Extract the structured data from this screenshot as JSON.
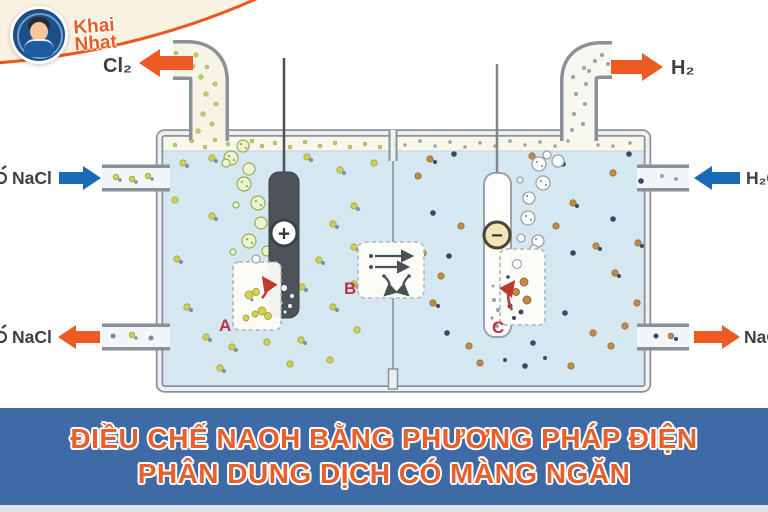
{
  "brand": {
    "line1": "Khai",
    "line2": "Nhat"
  },
  "diagram": {
    "gas_left_label": "Cl₂",
    "gas_right_label": "H₂",
    "inlet_left_label": "NaCl",
    "outlet_left_label": "NaCl",
    "inlet_right_label": "H₂O",
    "outlet_right_label": "NaOH",
    "anode_sign": "+",
    "cathode_sign": "−",
    "inset_a": "A",
    "inset_b": "B",
    "inset_c": "C"
  },
  "banner": {
    "line1": "ĐIỀU CHẾ NAOH BẰNG PHƯƠNG PHÁP ĐIỆN",
    "line2": "PHÂN DUNG DỊCH CÓ MÀNG NGĂN"
  },
  "colors": {
    "banner_bg": "#3e6aa6",
    "banner_text": "#e95f2b",
    "outflow_arrow": "#ee5a24",
    "inflow_arrow": "#1a6ab8",
    "water": "#d5e8f2",
    "label_text": "#3c4148",
    "inset_letter": "#c03048"
  }
}
